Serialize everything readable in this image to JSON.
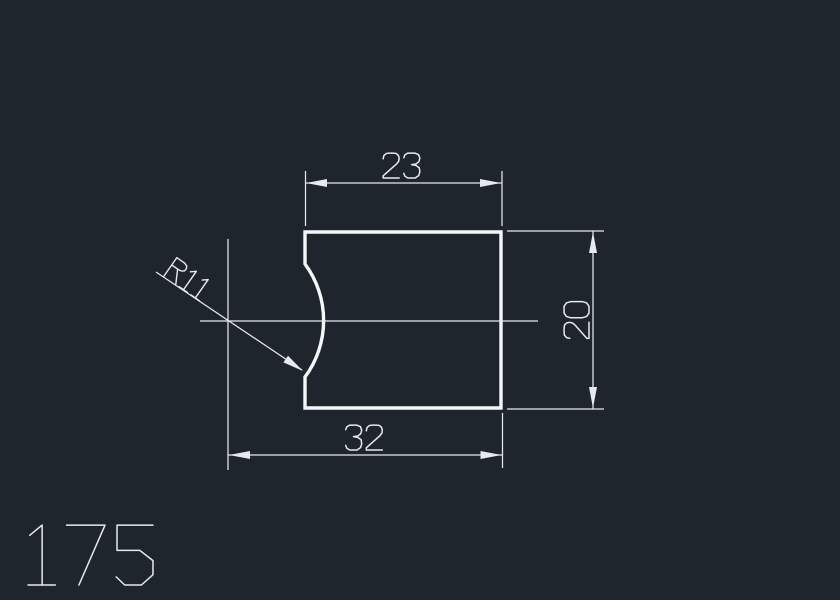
{
  "drawing": {
    "type": "2d-part-drawing",
    "background": "#1f252d",
    "line_color": "#e7eaed",
    "outline_color": "#f6f7f9",
    "labels": {
      "dim_top_width": "23",
      "dim_bottom_width": "32",
      "dim_height": "20",
      "dim_radius": "R11",
      "part_number": "175"
    }
  }
}
